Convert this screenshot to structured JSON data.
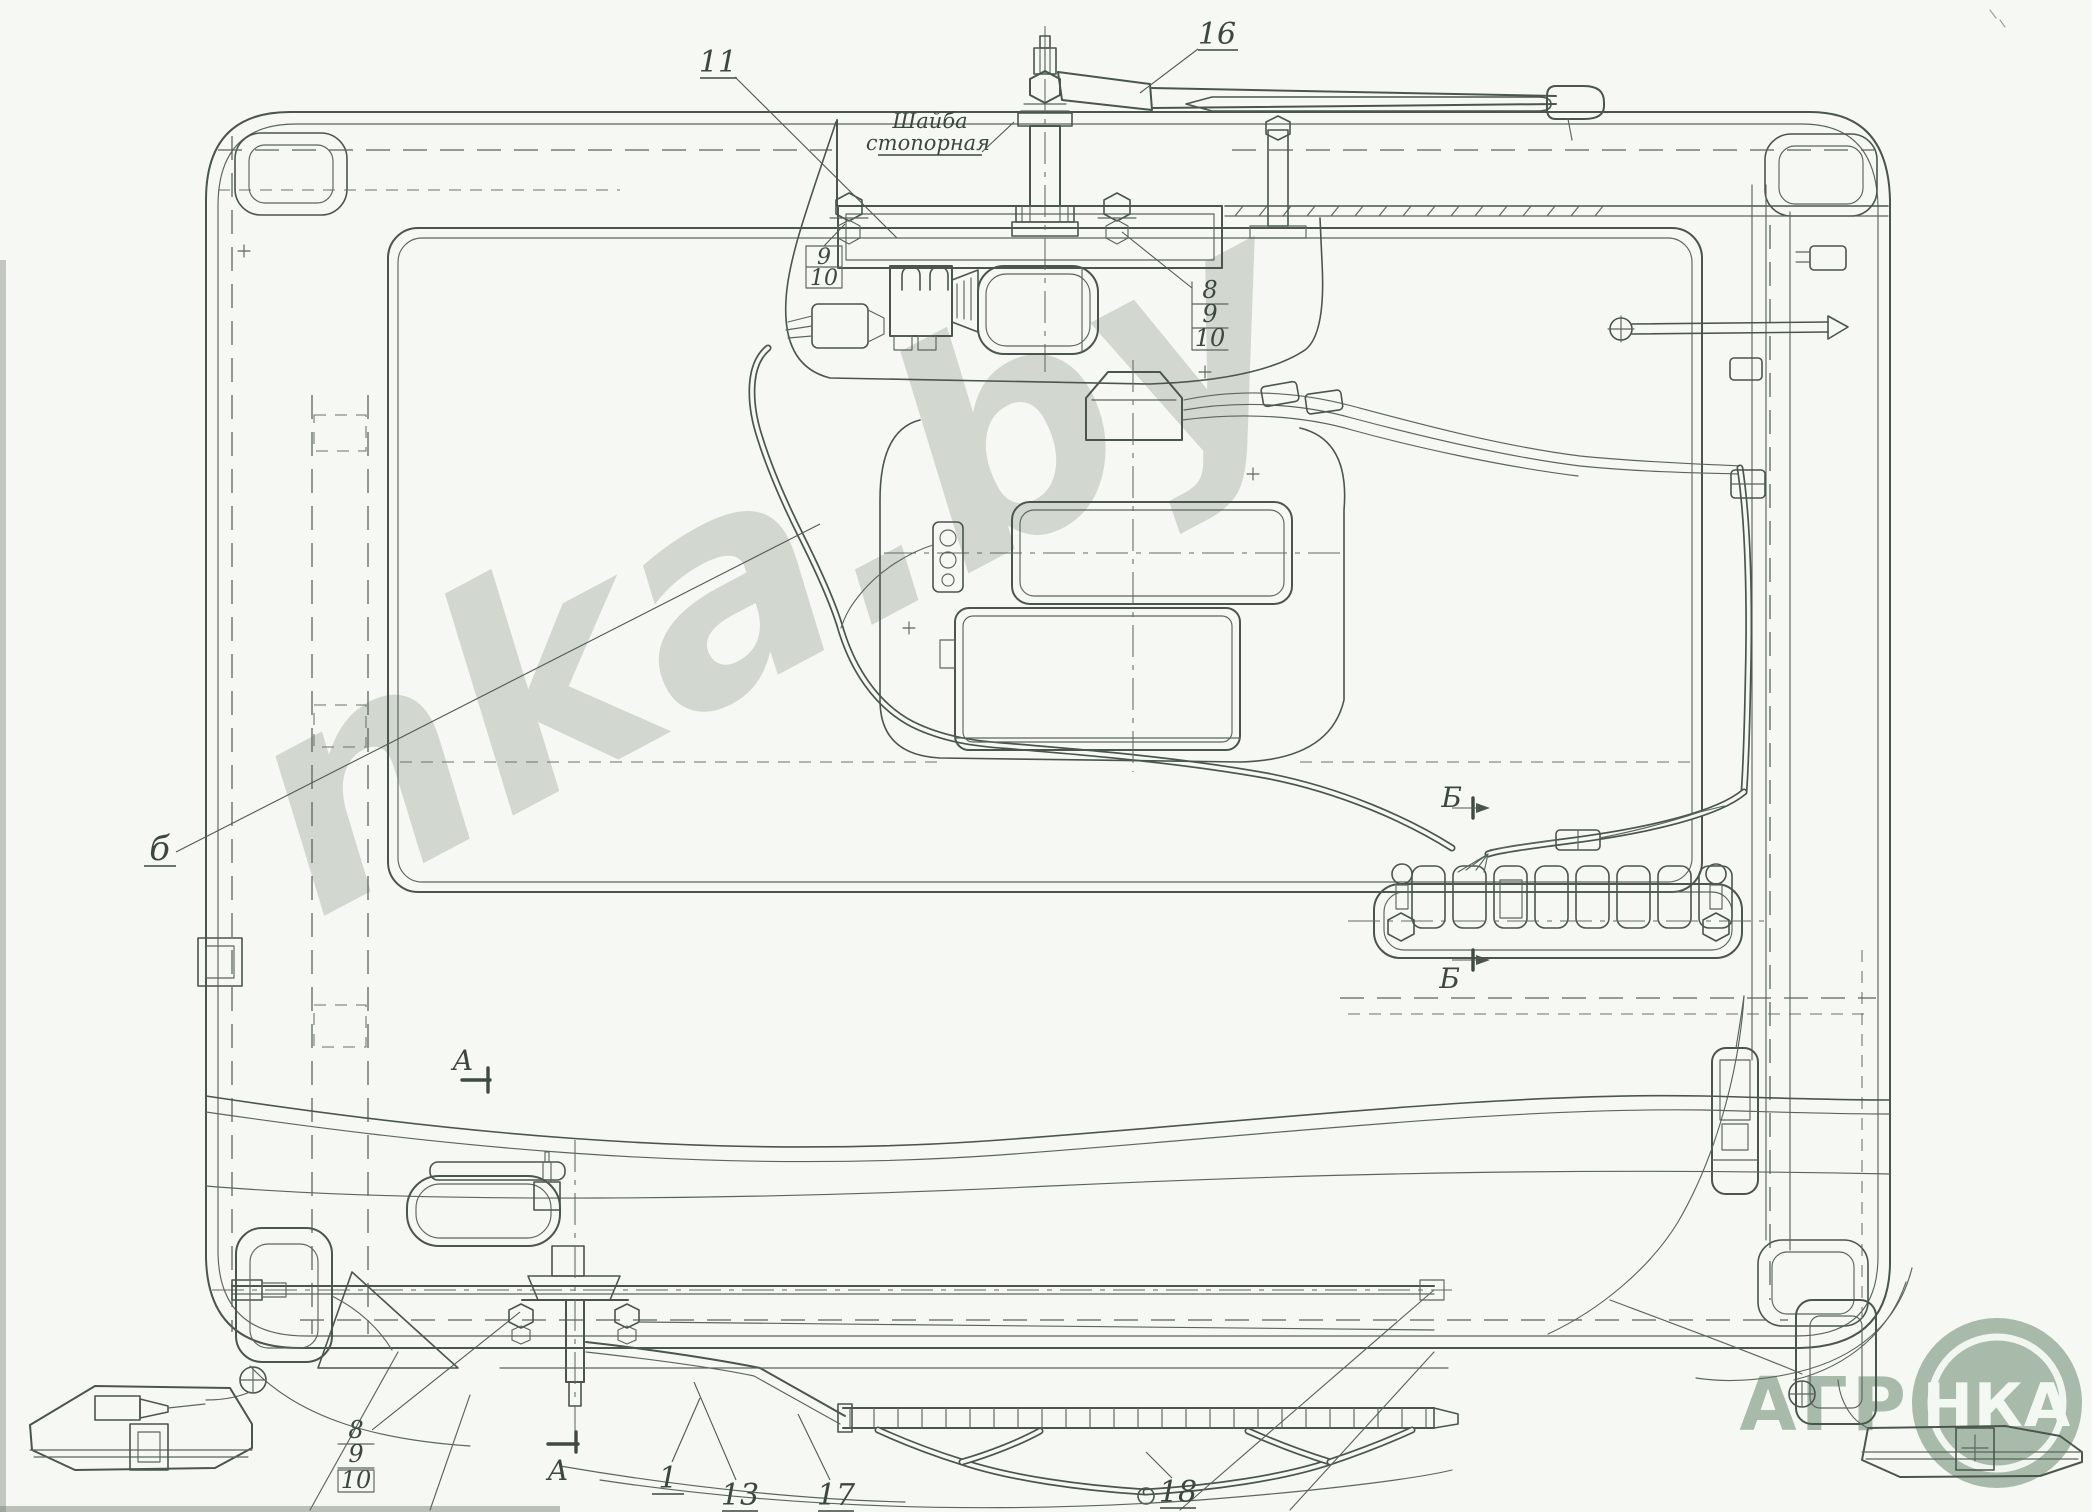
{
  "page": {
    "background": "#f6f9f3",
    "ink_color": "#4a564d",
    "thin_line_color": "#5a665c"
  },
  "watermark": {
    "text": "nka.by",
    "color": "#ccd3cb"
  },
  "logo": {
    "text_left": "АГР",
    "text_circle": "НКА",
    "brand": "АГРОНКА",
    "green": "#a2b5a4",
    "ring_color": "#f2f6f0",
    "circle_text_color": "#f4f8f2"
  },
  "annotations": {
    "lock_washer_l1": "Шайба",
    "lock_washer_l2": "стопорная"
  },
  "callouts": {
    "c11": "11",
    "c16": "16",
    "c1": "1",
    "c13": "13",
    "c17": "17",
    "c18": "18",
    "harness": "б"
  },
  "sections": {
    "a": "А",
    "b": "Б"
  },
  "stacks": {
    "top_left": {
      "r1": "9",
      "r2": "10"
    },
    "top_right": {
      "r1": "8",
      "r2": "9",
      "r3": "10"
    },
    "bottom_left": {
      "r1": "8",
      "r2": "9",
      "r3": "10"
    }
  }
}
